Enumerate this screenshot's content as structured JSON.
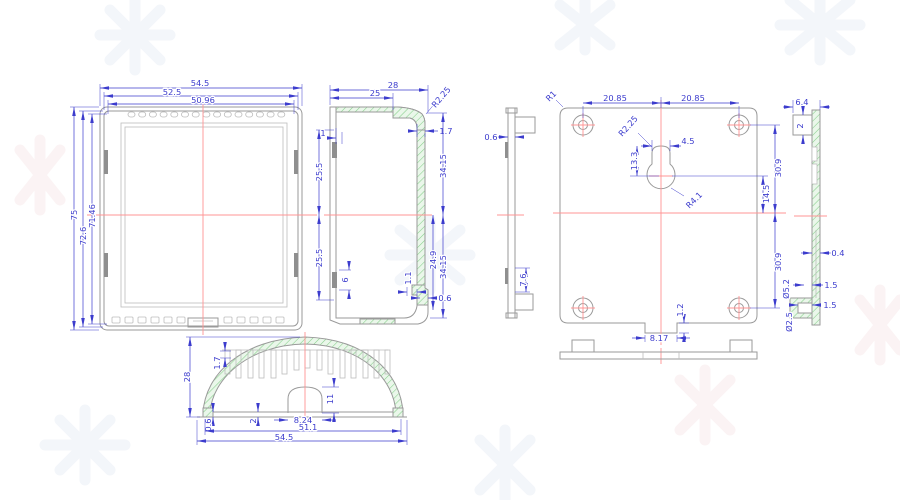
{
  "drawing": {
    "background": "#ffffff",
    "colors": {
      "dimension_blue": "#3c3ccd",
      "outline_gray": "#9a9a9a",
      "centerline_red": "#ff9494",
      "hatch_green": "#86cf8b",
      "hatch_fill": "#eaf7ea"
    }
  },
  "dims": {
    "front": {
      "w_outer": "54.5",
      "w_mid": "52.5",
      "w_inner": "50.96",
      "h_outer": "75",
      "h_mid": "72.6",
      "h_inner": "71.46"
    },
    "section": {
      "depth": "28",
      "depth_inner": "25",
      "corner_radius": "R2.25",
      "lip": "1",
      "step": "1.7",
      "half_upper": "25.5",
      "half_lower": "25.5",
      "clip_len": "6",
      "inner_depth": "24.9",
      "half_height_upper": "34.15",
      "half_height_lower": "34.15",
      "notch_w": "1.1",
      "notch_h": "0.6"
    },
    "bottom": {
      "height": "28",
      "rib": "1.7",
      "boss_h": "11",
      "hole_dia": "8.24",
      "wall": "0.6",
      "base": "2",
      "w_inner": "51.1",
      "w_outer": "54.5"
    },
    "back": {
      "corner_radius": "R1",
      "hole_left": "20.85",
      "hole_right": "20.85",
      "key_radius": "R2.25",
      "key_slot_w": "4.5",
      "key_slot_h": "13.3",
      "key_hole_r": "R4.1",
      "key_center": "14.5",
      "v_upper": "30.9",
      "v_lower": "30.9",
      "edge": "0.6",
      "tab": "7.6",
      "notch_w": "8.17",
      "notch_h": "1.2"
    },
    "side": {
      "width": "6.4",
      "tab": "2",
      "thickness": "0.4",
      "gap1": "1.5",
      "gap2": "1.5",
      "dia_outer": "Ø5.2",
      "dia_inner": "Ø2.5"
    }
  }
}
